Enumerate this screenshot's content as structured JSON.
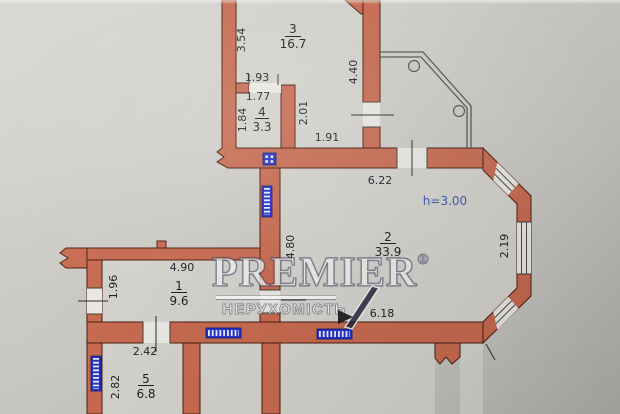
{
  "watermark": {
    "brand": "PREMIER",
    "registered": "®",
    "subtitle": "НЕРУХОМІСТЬ"
  },
  "plan": {
    "ceiling_height_label": "h=3.00",
    "rooms": [
      {
        "number": "1",
        "area": "9.6"
      },
      {
        "number": "2",
        "area": "33.9"
      },
      {
        "number": "3",
        "area": "16.7"
      },
      {
        "number": "4",
        "area": "3.3"
      },
      {
        "number": "5",
        "area": "6.8"
      }
    ],
    "dimensions": {
      "room3_left_height": "3.54",
      "room4_door_outer": "1.93",
      "room4_door_inner": "1.77",
      "room4_left_height": "1.84",
      "room4_right_height": "2.01",
      "room3_passage_width": "1.91",
      "room3_right_height": "4.40",
      "room2_top_width": "6.22",
      "room2_left_height": "4.80",
      "room2_bottom_width": "6.18",
      "bay_window_width": "2.19",
      "room1_top_width": "4.90",
      "room1_left_height": "1.96",
      "room5_top_width": "2.42",
      "room5_left_height": "2.82"
    },
    "symbols": {
      "radiator_count": 4,
      "vent_shaft_count": 1,
      "balcony": "open-railing"
    },
    "colors": {
      "wall": "#c66a50",
      "paper": "#c9c8c3",
      "radiator_blue": "#2633c8",
      "height_note_blue": "#3b57b0"
    }
  }
}
